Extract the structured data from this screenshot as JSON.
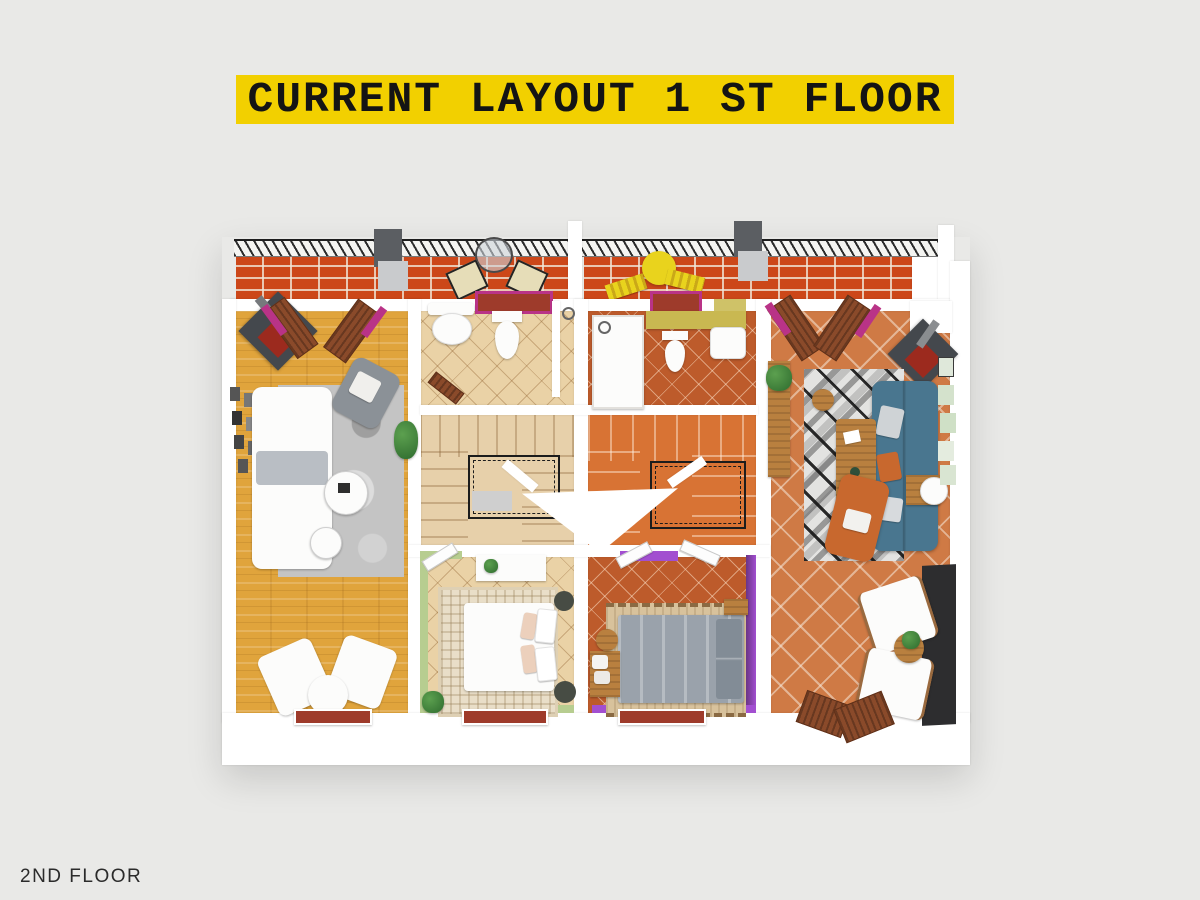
{
  "banner": {
    "title": "CURRENT LAYOUT 1 ST FLOOR"
  },
  "footer": {
    "label": "2ND FLOOR"
  },
  "colors": {
    "page_bg": "#e9e9e7",
    "banner_bg": "#f2d000",
    "banner_text": "#141414",
    "footer_text": "#2b2b2b",
    "wall": "#ffffff",
    "brick": "#cc4719",
    "wood_floor": "#e0a43c",
    "tile_beige": "#ead2a6",
    "tile_terracotta": "#bd5b2b",
    "tile_terracotta_light": "#cf7a45",
    "stair_beige": "#e7d0aa",
    "stair_orange": "#d87334",
    "green_wall": "#b7cd90",
    "purple_wall": "#a24fd0",
    "purple_wall_dark": "#6a3585",
    "blue_sofa": "#49768f",
    "orange_chair": "#c8682e",
    "olive_counter": "#c9b851",
    "magenta_accent": "#b93387",
    "sill_red": "#9e3b2b",
    "charcoal": "#2d2d2f",
    "rug_gray": "#c4c4c4",
    "door_wood": "#8a4a2a",
    "yellow_umbrella": "#e9d31d",
    "chimney_dark": "#5b5e62",
    "chimney_light": "#c9cbcd"
  }
}
